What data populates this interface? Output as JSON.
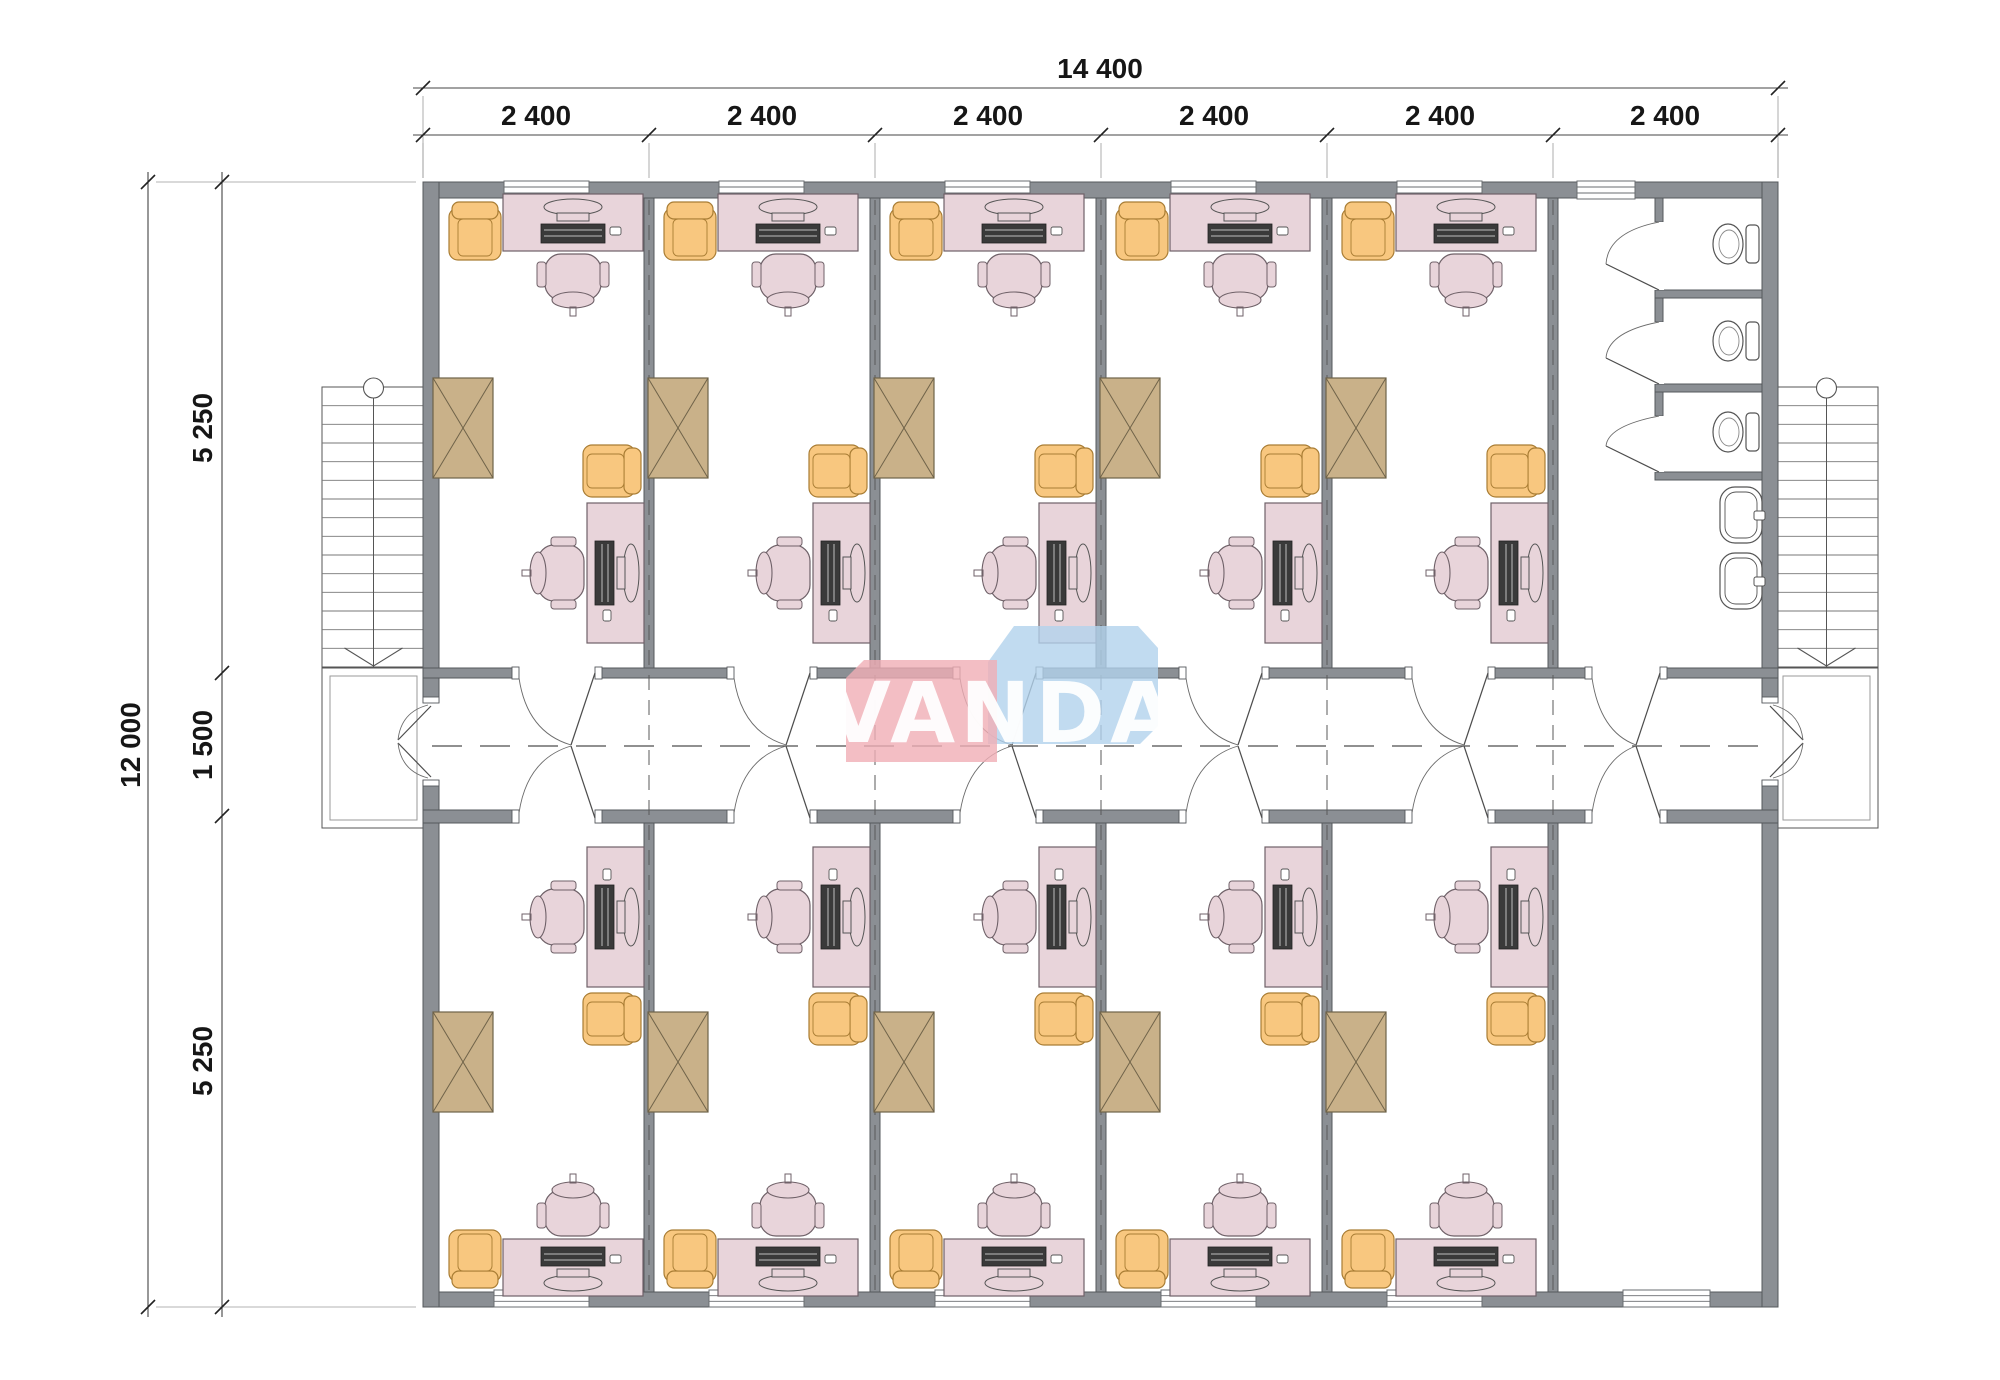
{
  "title": "office-building-floor-plan",
  "dimensions": {
    "top": {
      "total": "14 400",
      "segments": [
        "2 400",
        "2 400",
        "2 400",
        "2 400",
        "2 400",
        "2 400"
      ]
    },
    "left": {
      "total": "12 000",
      "segments": [
        "5 250",
        "1 500",
        "5 250"
      ]
    }
  },
  "watermark": {
    "text": "VANDA",
    "pink_block": "#f0aeb5",
    "blue_block": "#b2d2ec"
  },
  "palette": {
    "wall": "#8b8f94",
    "wall_stroke": "#55585c",
    "desk": "#e8d4da",
    "desk_stroke": "#6f6168",
    "chair_orange": "#f8c77f",
    "chair_orange_stroke": "#a97d34",
    "table_tan": "#c9b189",
    "table_tan_stroke": "#6f6349",
    "keyboard": "#3a3a3a",
    "fixture_stroke": "#555555"
  },
  "plan": {
    "offices_top_row": 5,
    "offices_bottom_row": 5,
    "toilet_stalls": 3,
    "sinks": 2,
    "staircases": 2,
    "corridor": 1
  }
}
